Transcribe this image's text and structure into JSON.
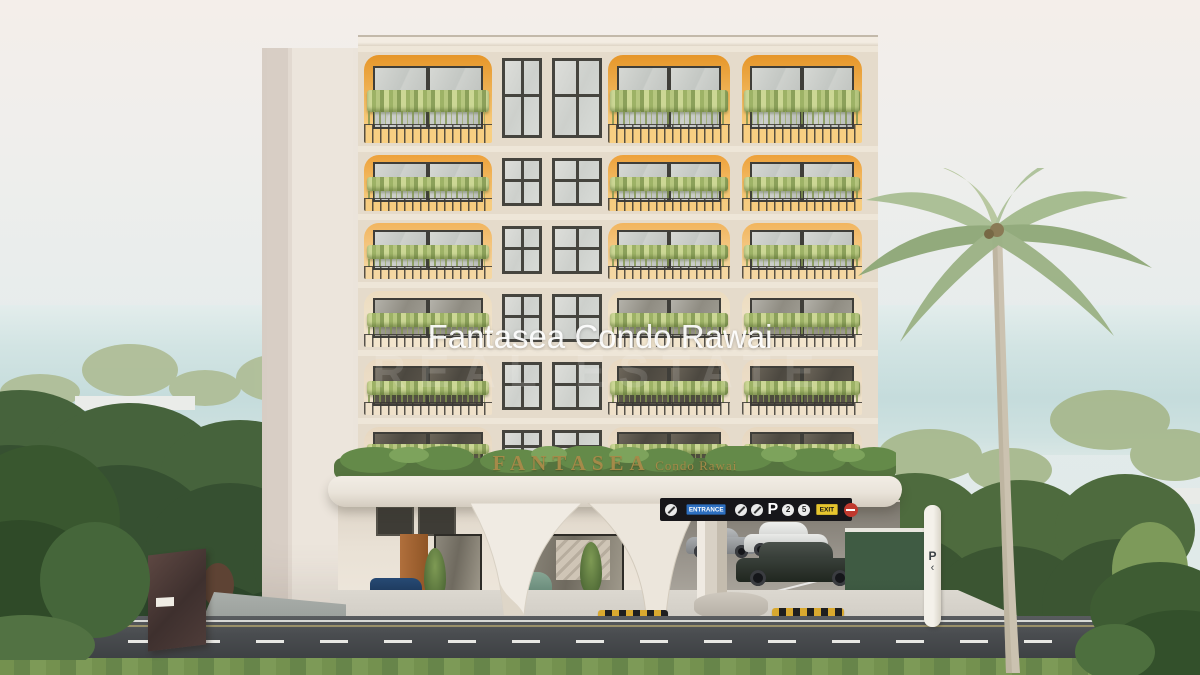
{
  "scene": {
    "description": "3D exterior rendering of a 7-storey tropical condominium with orange arched balconies, hanging plants, rooftop-garden entrance canopy, covered parking, palm trees and sea horizon",
    "palette": {
      "sky_top": "#f4eeea",
      "sea": "#c5dcdc",
      "facade_cream": "#e7ddce",
      "balcony_orange": "#e89a30",
      "plants_green": "#9db266",
      "hedge_green": "#3f5c3b",
      "canopy_white": "#efeae2",
      "sign_gold": "#a58a49",
      "road_asphalt": "#4a4d50",
      "grass_green": "#74914f",
      "entrance_blue": "#2d6fc0",
      "exit_yellow": "#e6c52e",
      "noentry_red": "#c0392e"
    }
  },
  "watermark": {
    "title": "Fantasea Condo Rawai",
    "subtitle": "REAL ESTATE"
  },
  "canopy_sign": {
    "brand": "FANTASEA",
    "suffix": "Condo Rawai"
  },
  "parking_sign": {
    "entrance_label": "ENTRANCE",
    "parking_letter": "P",
    "limit_badge_1": "2",
    "limit_badge_2": "5",
    "exit_label": "EXIT"
  },
  "pylon": {
    "letter": "P",
    "arrow": "‹"
  },
  "building": {
    "floor_count": 6,
    "floors": [
      {
        "level": 7,
        "height": 100,
        "arch_top": "#e69629",
        "arch_bottom": "#f8cf82",
        "glass": "light"
      },
      {
        "level": 6,
        "height": 68,
        "arch_top": "#eda13a",
        "arch_bottom": "#f6cc80",
        "glass": "light"
      },
      {
        "level": 5,
        "height": 68,
        "arch_top": "#f2b55e",
        "arch_bottom": "#f5d7a2",
        "glass": "light"
      },
      {
        "level": 4,
        "height": 68,
        "arch_top": "#ecdcc0",
        "arch_bottom": "#f2e5cd",
        "glass": "mid"
      },
      {
        "level": 3,
        "height": 68,
        "arch_top": "#e9d9c2",
        "arch_bottom": "#efe1ca",
        "glass": "dark"
      },
      {
        "level": 2,
        "height": 54,
        "arch_top": "#e7d7c0",
        "arch_bottom": "#ede0cb",
        "glass": "dark"
      }
    ]
  }
}
